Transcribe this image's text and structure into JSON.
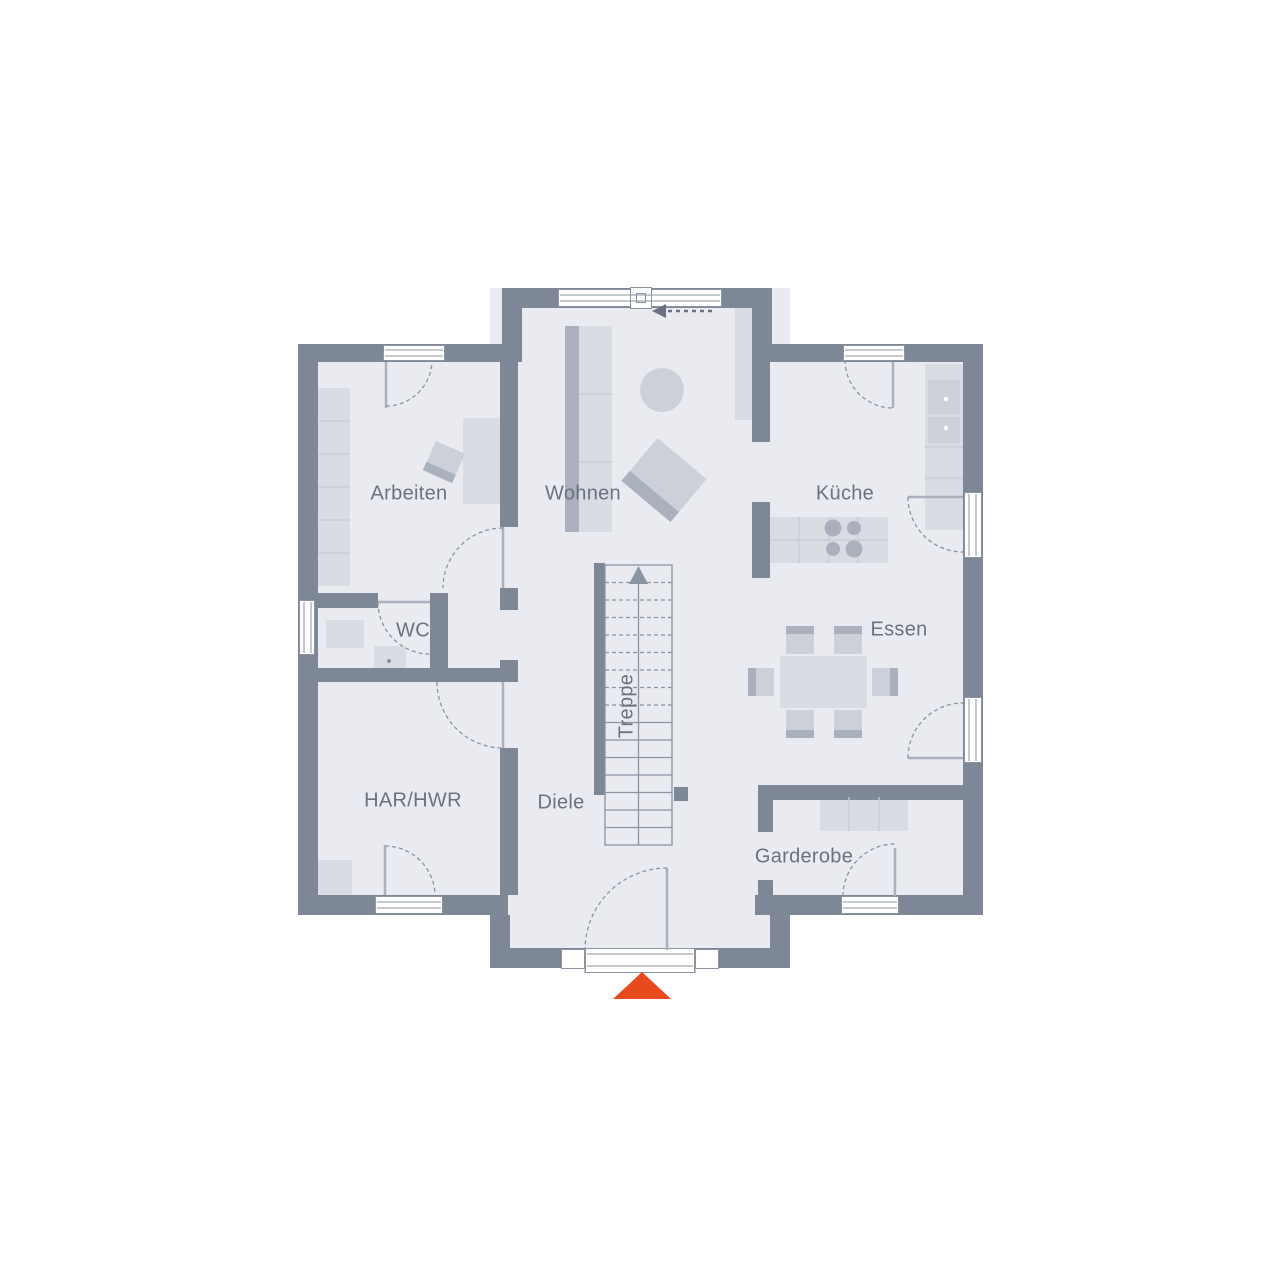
{
  "plan": {
    "type": "residential-ground-floor-plan",
    "language": "de"
  },
  "rooms": [
    {
      "id": "arbeiten",
      "label": "Arbeiten"
    },
    {
      "id": "wohnen",
      "label": "Wohnen"
    },
    {
      "id": "kueche",
      "label": "Küche"
    },
    {
      "id": "wc",
      "label": "WC"
    },
    {
      "id": "essen",
      "label": "Essen"
    },
    {
      "id": "treppe",
      "label": "Treppe"
    },
    {
      "id": "har_hwr",
      "label": "HAR/HWR"
    },
    {
      "id": "diele",
      "label": "Diele"
    },
    {
      "id": "garderobe",
      "label": "Garderobe"
    }
  ],
  "icons": {
    "entrance_marker": "entrance-triangle-up",
    "stair_direction": "arrow-up",
    "window_slide_direction": "arrow-left-dashed"
  },
  "colors": {
    "wall": "#7d8796",
    "floor": "#e9ebf0",
    "white": "#ffffff",
    "line": "#8c94a2",
    "grid": "#c6cbd4",
    "furniture_light": "#d9dce3",
    "furniture_mid": "#ccd1d9",
    "furniture_dark": "#aab1bd",
    "text": "#6a7280",
    "accent": "#e8491d"
  }
}
